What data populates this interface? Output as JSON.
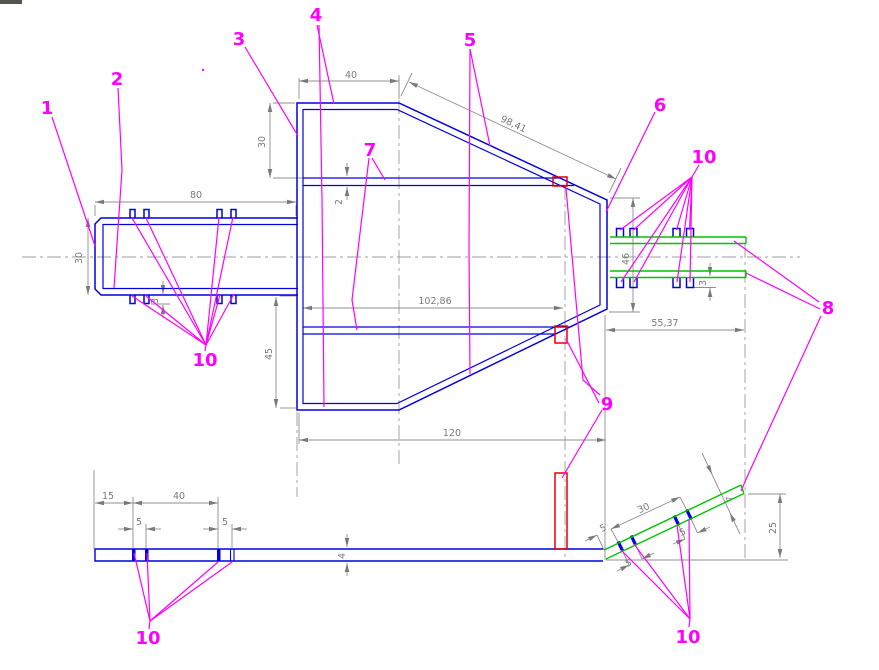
{
  "drawing": {
    "part_labels": {
      "p1": "1",
      "p2": "2",
      "p3": "3",
      "p4": "4",
      "p5": "5",
      "p6": "6",
      "p7": "7",
      "p8": "8",
      "p9": "9",
      "p10": "10"
    },
    "dimensions": {
      "tube_length": "80",
      "tube_height": "30",
      "tab_height": "3",
      "top_flange": "40",
      "top_drop": "30",
      "rail_thickness": "2",
      "diagonal_length": "98,41",
      "rail_length": "102,86",
      "lower_drop": "45",
      "base_width": "120",
      "right_height": "46",
      "clip_height": "3",
      "extension_length": "55,37",
      "strip_offset": "15",
      "strip_span": "40",
      "slot_pitch_left": "5",
      "slot_pitch_right": "5",
      "strip_thickness": "4",
      "incline_start": "5",
      "incline_span": "30",
      "incline_slot_pitch": "5",
      "incline_slot_pitch2": "5",
      "incline_thickness": "4",
      "incline_rise": "25"
    },
    "colors": {
      "geometry_blue": "#0000e0",
      "plank_green": "#00c400",
      "highlight_red": "#e80000",
      "leader_magenta": "#ff00ff",
      "dimension_gray": "#7a7a7a"
    }
  }
}
